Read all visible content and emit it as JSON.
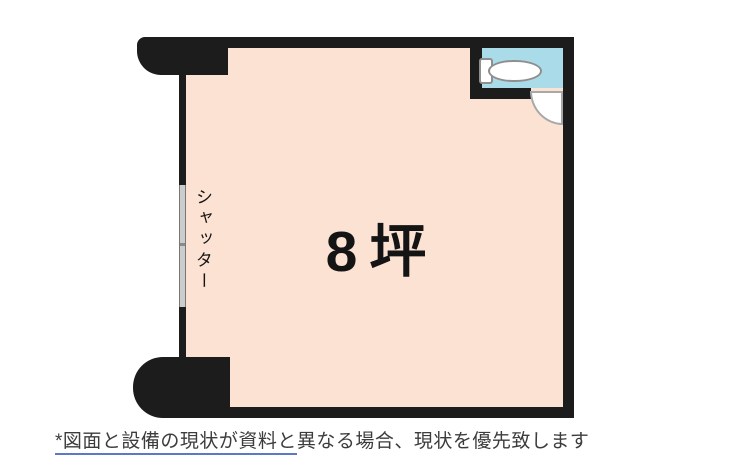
{
  "colors": {
    "wall": "#1c1c1c",
    "room-fill": "#fce2d2",
    "toilet-fill": "#a9dce8",
    "shutter-fill": "#cccccc",
    "underline": "#5b79c9"
  },
  "floor_plan": {
    "area_label": "8坪",
    "shutter_label": "シャッター",
    "icons": {
      "toilet": "toilet-icon",
      "door": "door-swing-arc-icon"
    }
  },
  "disclaimer": {
    "underlined_text": "*図面と設備の現状が資料と",
    "rest_text": "異なる場合、現状を優先致します"
  }
}
